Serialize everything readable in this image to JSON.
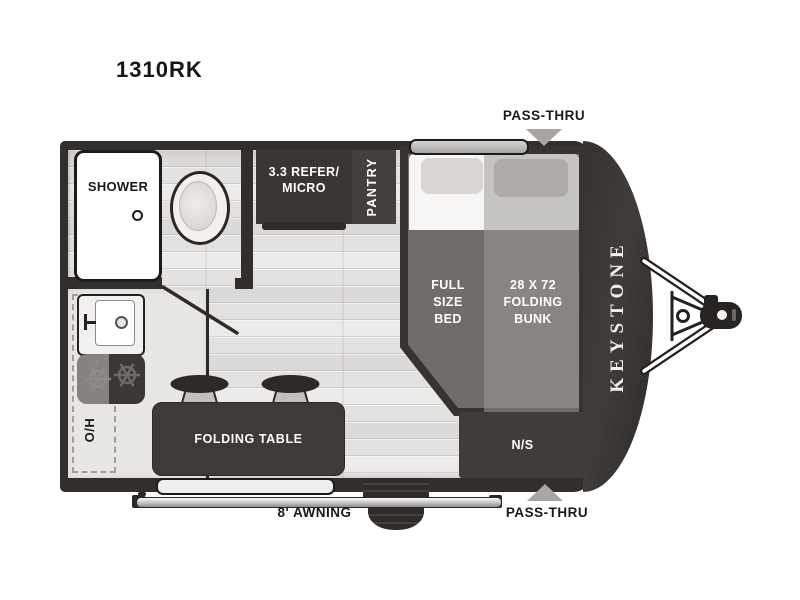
{
  "title": "1310RK",
  "brand": "KEYSTONE",
  "callouts": {
    "pass_thru_top": "PASS-THRU",
    "pass_thru_bottom": "PASS-THRU",
    "awning": "8' AWNING"
  },
  "rooms": {
    "shower": "SHOWER",
    "refer_micro": [
      "3.3 REFER/",
      "MICRO"
    ],
    "pantry": "PANTRY",
    "full_size_bed": [
      "FULL",
      "SIZE",
      "BED"
    ],
    "folding_bunk": [
      "28 X 72",
      "FOLDING",
      "BUNK"
    ],
    "folding_table": "FOLDING TABLE",
    "overhead_cabinet": "O/H",
    "nightstand": "N/S"
  },
  "colors": {
    "wall": "#312e2c",
    "furniture_dark": "#3b3734",
    "floor": "#e4e2e0",
    "bed_platform": "#716c68",
    "bunk_overlay": "#9e9a96",
    "arrow_gray": "#a8a5a2",
    "text_dark": "#1b1a19",
    "text_light": "#ffffff"
  }
}
